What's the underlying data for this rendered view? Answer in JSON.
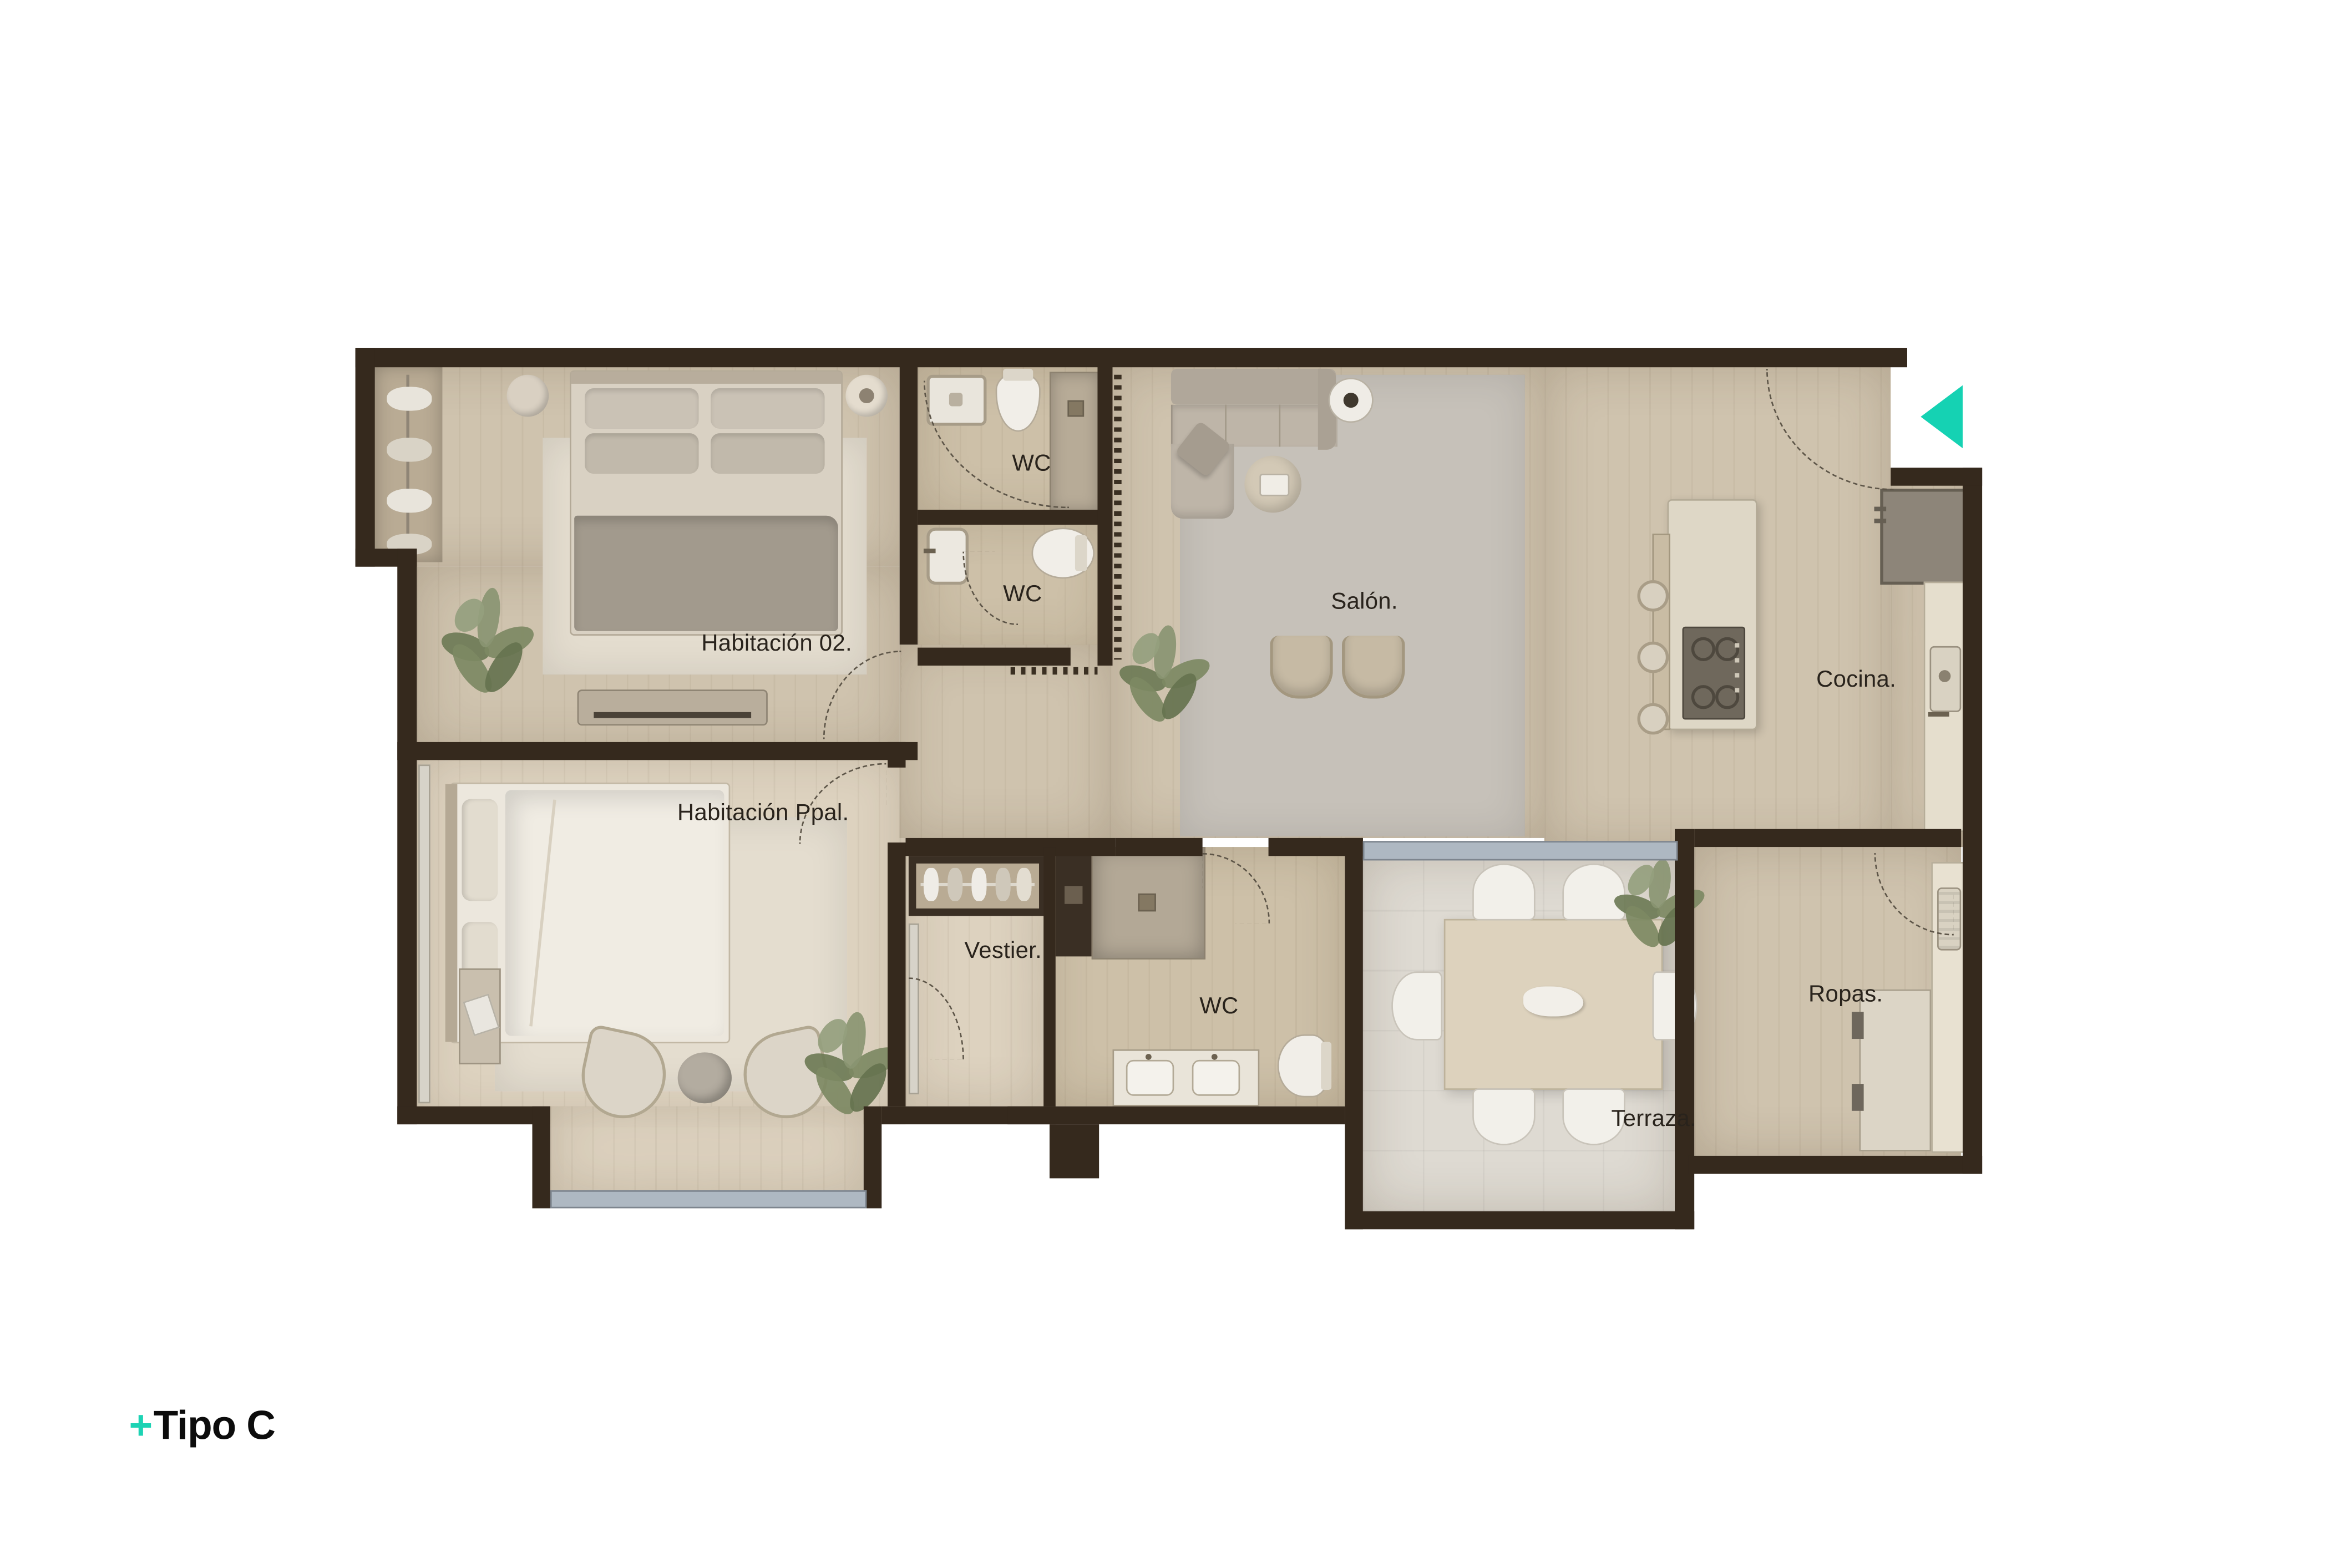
{
  "page": {
    "background": "#ffffff",
    "type": "apartment floor plan"
  },
  "logo": {
    "plus": "+",
    "name": "Tipo C"
  },
  "plan": {
    "marker": {
      "name": "entry-arrow",
      "direction": "left",
      "color": "#15D2B3"
    },
    "colors": {
      "accent_teal": "#15D2B3",
      "wall": "#35291D",
      "floor_wood": "#CFC3AE",
      "floor_wood_light": "#DDD2BF",
      "terrace_tile": "#DEDAD2",
      "rug": "#C6C1B9",
      "glass": "#AEB8C2",
      "label_text": "#29231C"
    },
    "rooms": [
      {
        "id": "habitacion-02",
        "label": "Habitación 02."
      },
      {
        "id": "wc-1",
        "label": "WC"
      },
      {
        "id": "wc-2",
        "label": "WC"
      },
      {
        "id": "salon",
        "label": "Salón."
      },
      {
        "id": "cocina",
        "label": "Cocina."
      },
      {
        "id": "habitacion-ppal",
        "label": "Habitación Ppal."
      },
      {
        "id": "vestier",
        "label": "Vestier."
      },
      {
        "id": "wc-3",
        "label": "WC"
      },
      {
        "id": "terraza",
        "label": "Terraza."
      },
      {
        "id": "ropas",
        "label": "Ropas."
      }
    ]
  }
}
